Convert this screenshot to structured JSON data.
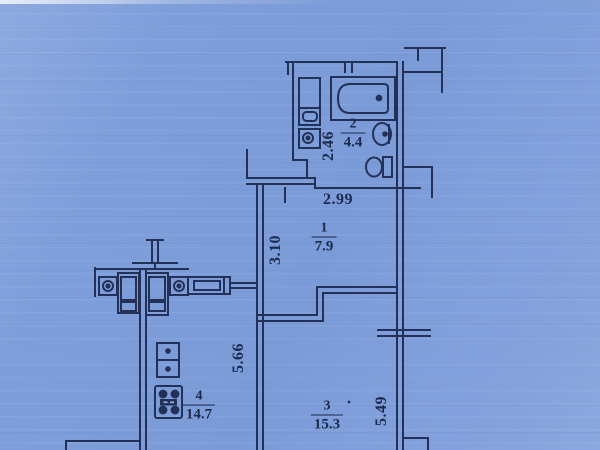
{
  "document": {
    "kind": "apartment floor plan (photo on blue paper)"
  },
  "colors": {
    "paper": "#7d9dd9",
    "ink": "#233158",
    "text": "#1c2a4e"
  },
  "rooms": [
    {
      "key": "hallway",
      "number": "1",
      "area": "7.9"
    },
    {
      "key": "bathroom",
      "number": "2",
      "area": "4.4"
    },
    {
      "key": "living",
      "number": "3",
      "area": "15.3"
    },
    {
      "key": "kitchen",
      "number": "4",
      "area": "14.7"
    }
  ],
  "dimensions": {
    "bathroom_width": "2.46",
    "hallway_width": "2.99",
    "hallway_depth": "3.10",
    "kitchen_depth": "5.66",
    "living_depth": "5.49"
  },
  "fixtures": [
    {
      "key": "bathtub",
      "name": "bathtub"
    },
    {
      "key": "cabinet",
      "name": "bathroom-cabinet"
    },
    {
      "key": "washer",
      "name": "washing-machine"
    },
    {
      "key": "basin",
      "name": "wash-basin"
    },
    {
      "key": "toilet",
      "name": "toilet"
    },
    {
      "key": "kitchen_sink",
      "name": "double-kitchen-sink"
    },
    {
      "key": "stove",
      "name": "four-burner-stove"
    },
    {
      "key": "vents",
      "name": "ventilation-shafts"
    }
  ]
}
